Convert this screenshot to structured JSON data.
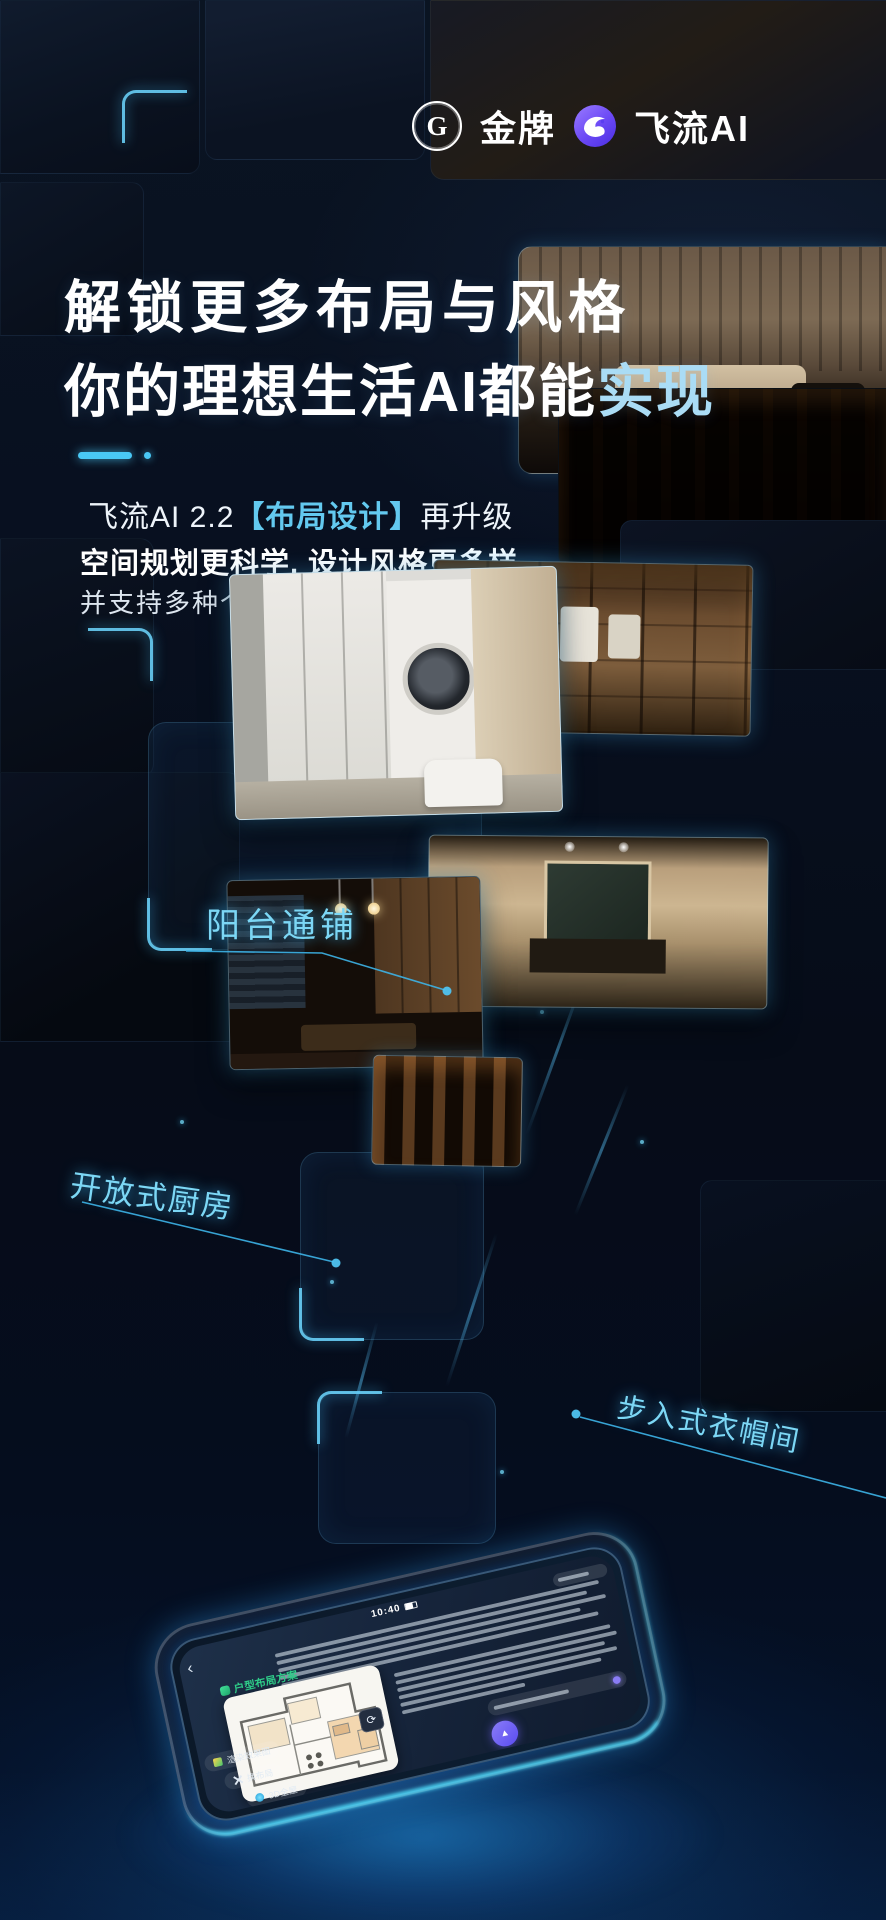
{
  "brand": {
    "gold_badge": "G",
    "gold_name": "金牌",
    "feiliu_name": "飞流AI"
  },
  "headline": {
    "line1": "解锁更多布局与风格",
    "line2_prefix": "你的理想生活",
    "line2_strong": "AI都能",
    "line2_accent": "实现"
  },
  "subtitle": {
    "l1_prefix": "飞流AI 2.2",
    "l1_highlight": "【布局设计】",
    "l1_suffix": "再升级",
    "l2": "空间规划更科学, 设计风格更多样",
    "l3": "并支持多种个性化空间生成"
  },
  "callouts": {
    "balcony": "阳台通铺",
    "kitchen": "开放式厨房",
    "closet": "步入式衣帽间"
  },
  "phone_ui": {
    "status_time": "10:40",
    "back_icon": "‹",
    "plan_title": "户型布局方案",
    "card_btn_icon": "⟳",
    "chips": [
      "渲染效果图",
      "换布局",
      "3D全屋"
    ],
    "fab_icon": "▲"
  },
  "colors": {
    "accent": "#49c8f5",
    "accent_text": "#7cd7f5",
    "headline_accent": "#aadcf5",
    "green": "#2fcf8a",
    "purple": "#8a7cf5"
  }
}
